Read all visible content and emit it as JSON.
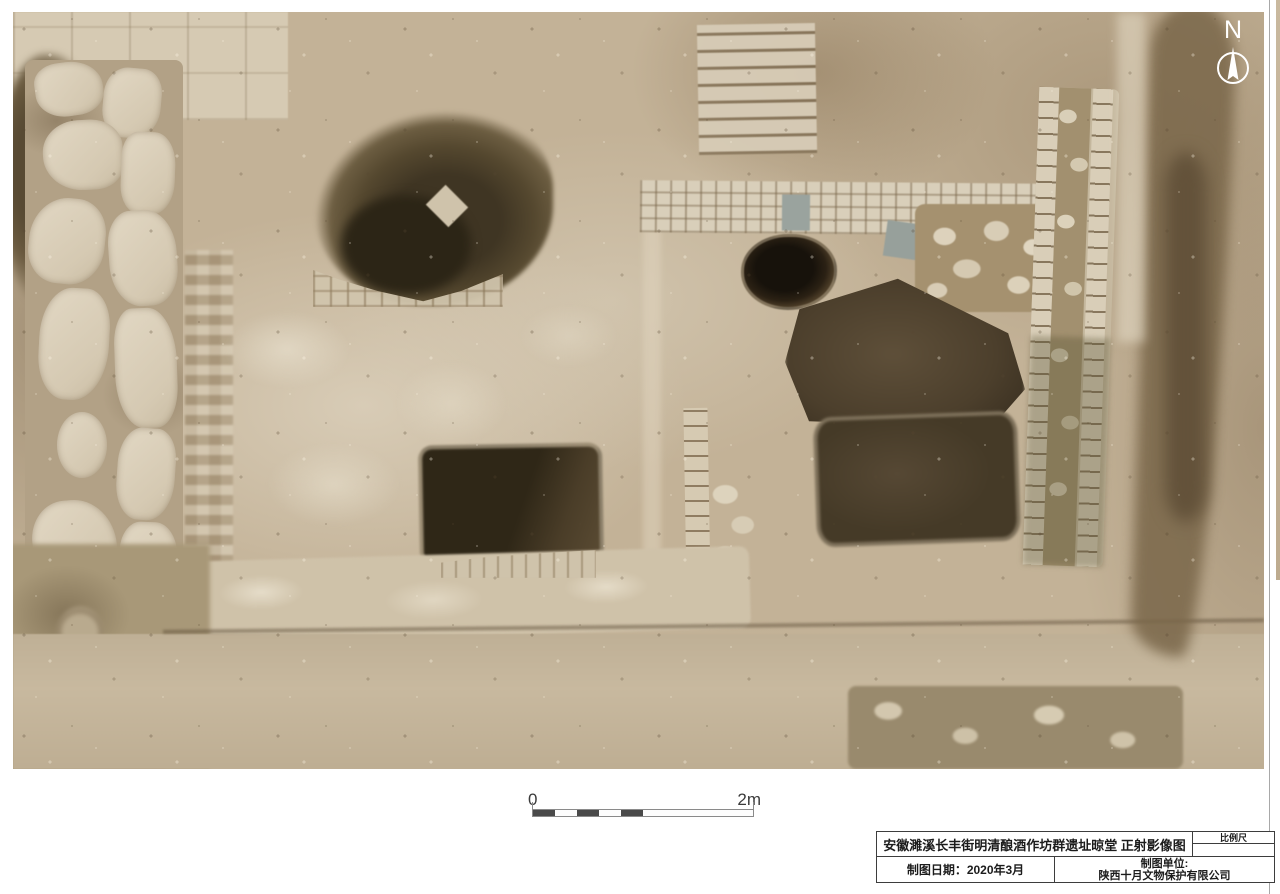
{
  "compass": {
    "label": "N"
  },
  "scale_bar": {
    "start_label": "0",
    "end_label": "2m"
  },
  "title_block": {
    "title": "安徽濉溪长丰街明清酿酒作坊群遗址晾堂 正射影像图",
    "scale_label": "比例尺",
    "scale_value": "",
    "date": "制图日期：2020年3月",
    "org_line1": "制图单位:",
    "org_line2": "陕西十月文物保护有限公司"
  },
  "palette": {
    "ground_tan": "#c3b297",
    "pale_stone": "#ddd2bc",
    "pit_brown": "#4c3f2c",
    "deep_hole_black": "#17120b",
    "frame_line": "#3d3d3d"
  }
}
